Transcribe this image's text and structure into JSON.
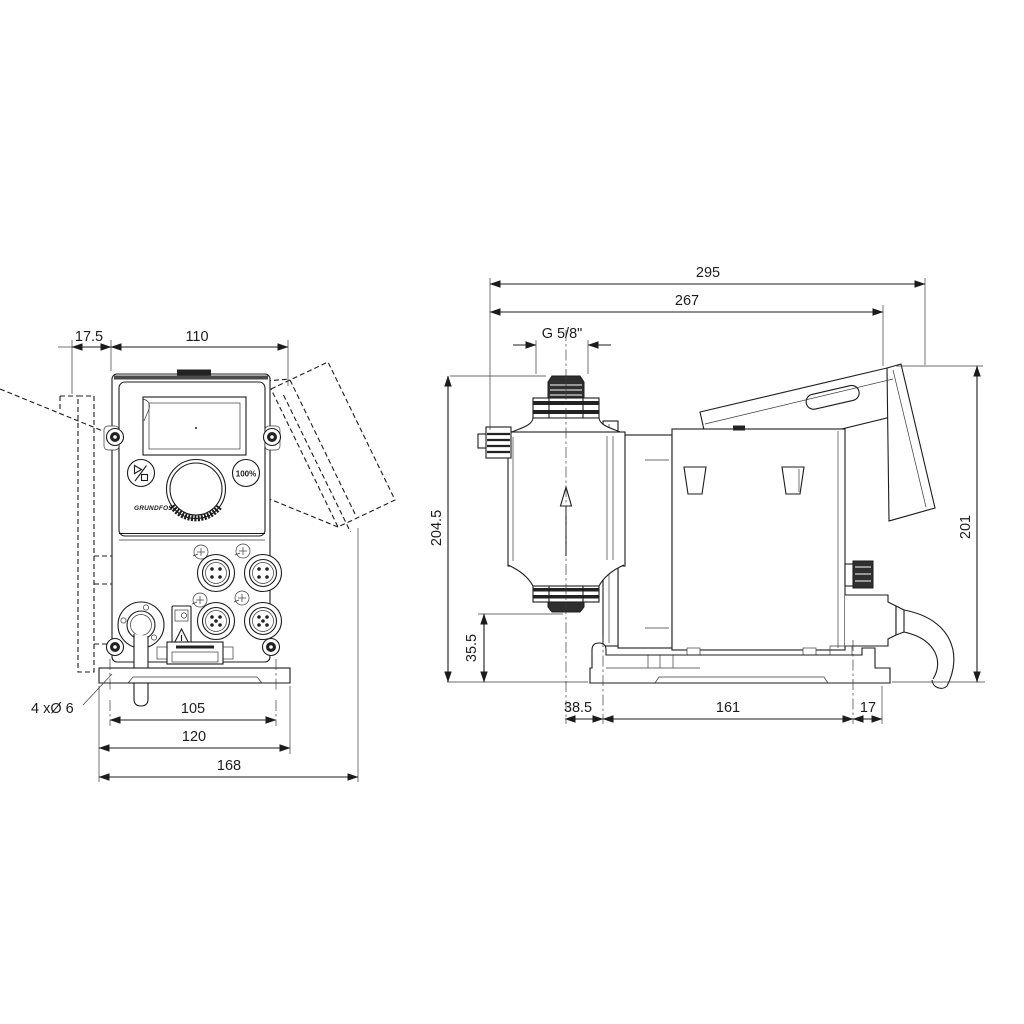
{
  "title": "Dosing pump dimensional drawing",
  "colors": {
    "background": "#ffffff",
    "line": "#1c1c1c",
    "accent_fill": "#222222"
  },
  "front_view": {
    "dim_wall_offset": "17.5",
    "dim_body_width": "110",
    "dim_hole_spacing": "105",
    "dim_plate_width": "120",
    "dim_overall_width": "168",
    "label_mounting_holes": "4 xØ 6",
    "button_percent": "100%",
    "brand": "GRUNDFOS"
  },
  "side_view": {
    "dim_total_depth": "295",
    "dim_housing_depth": "267",
    "dim_thread": "G 5/8\"",
    "dim_height_overall_left": "204.5",
    "dim_valve_height": "35.5",
    "dim_center_offset": "38.5",
    "dim_base_length": "161",
    "dim_base_end": "17",
    "dim_height_overall_right": "201"
  }
}
